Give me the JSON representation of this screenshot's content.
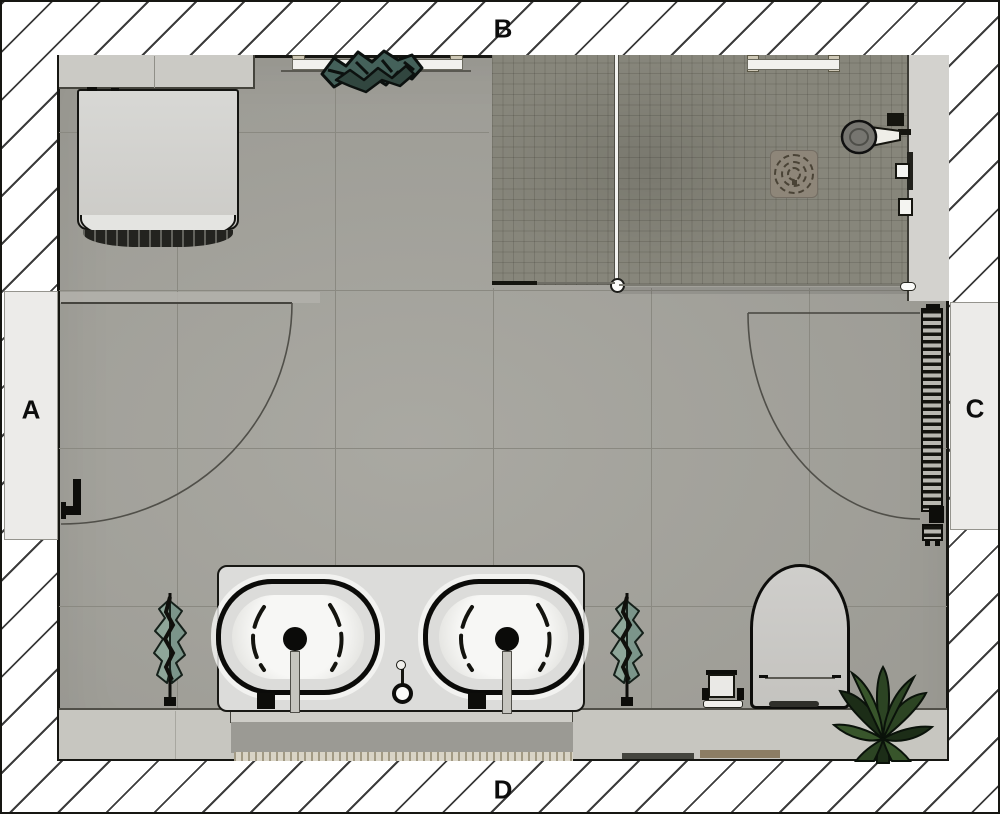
{
  "labels": {
    "left": "A",
    "top": "B",
    "right": "C",
    "bottom": "D"
  },
  "palette": {
    "wall_bg": "#ffffff",
    "wall_line": "#3c3c3c",
    "outline": "#161612",
    "floor": "#a5a49d",
    "floor_seam": "#8a8981",
    "mosaic": "#87867b",
    "furred_wall": "#d3d2ce",
    "opening": "#ecebe9",
    "shelf": "#cbcac5",
    "ledge": "#c7c6c0",
    "counter": "#dcdcda",
    "basin_white": "#f6f6f4",
    "rug": "#9b9a94",
    "fringe": "#d9d4c6",
    "towel": "#23231f",
    "tub": "#d3d3d0",
    "toilet": "#cac9c5",
    "radiator_gap": "#b9b8b1",
    "drain_plate": "#8e8679",
    "plant_dark": "#1c2d17",
    "plant_mid": "#2c4423",
    "plant_sage": "#8ea699",
    "plant_teal": "#44615a",
    "label_color": "#0c0c0c"
  },
  "fixtures": [
    "bathtub",
    "storage-shelf",
    "window-sill",
    "sill-plant",
    "walk-in-shower",
    "shower-glass-partition",
    "shower-screen",
    "shower-niche",
    "shower-drain",
    "hand-shower",
    "shower-controls",
    "door-a-swing",
    "door-c-swing",
    "door-handle",
    "towel-radiator",
    "double-vanity",
    "washbasin-left",
    "washbasin-right",
    "faucet",
    "bath-mat",
    "toilet",
    "toilet-brush-set",
    "floor-plant-left",
    "floor-plant-right",
    "corner-plant",
    "wall-ledge"
  ]
}
